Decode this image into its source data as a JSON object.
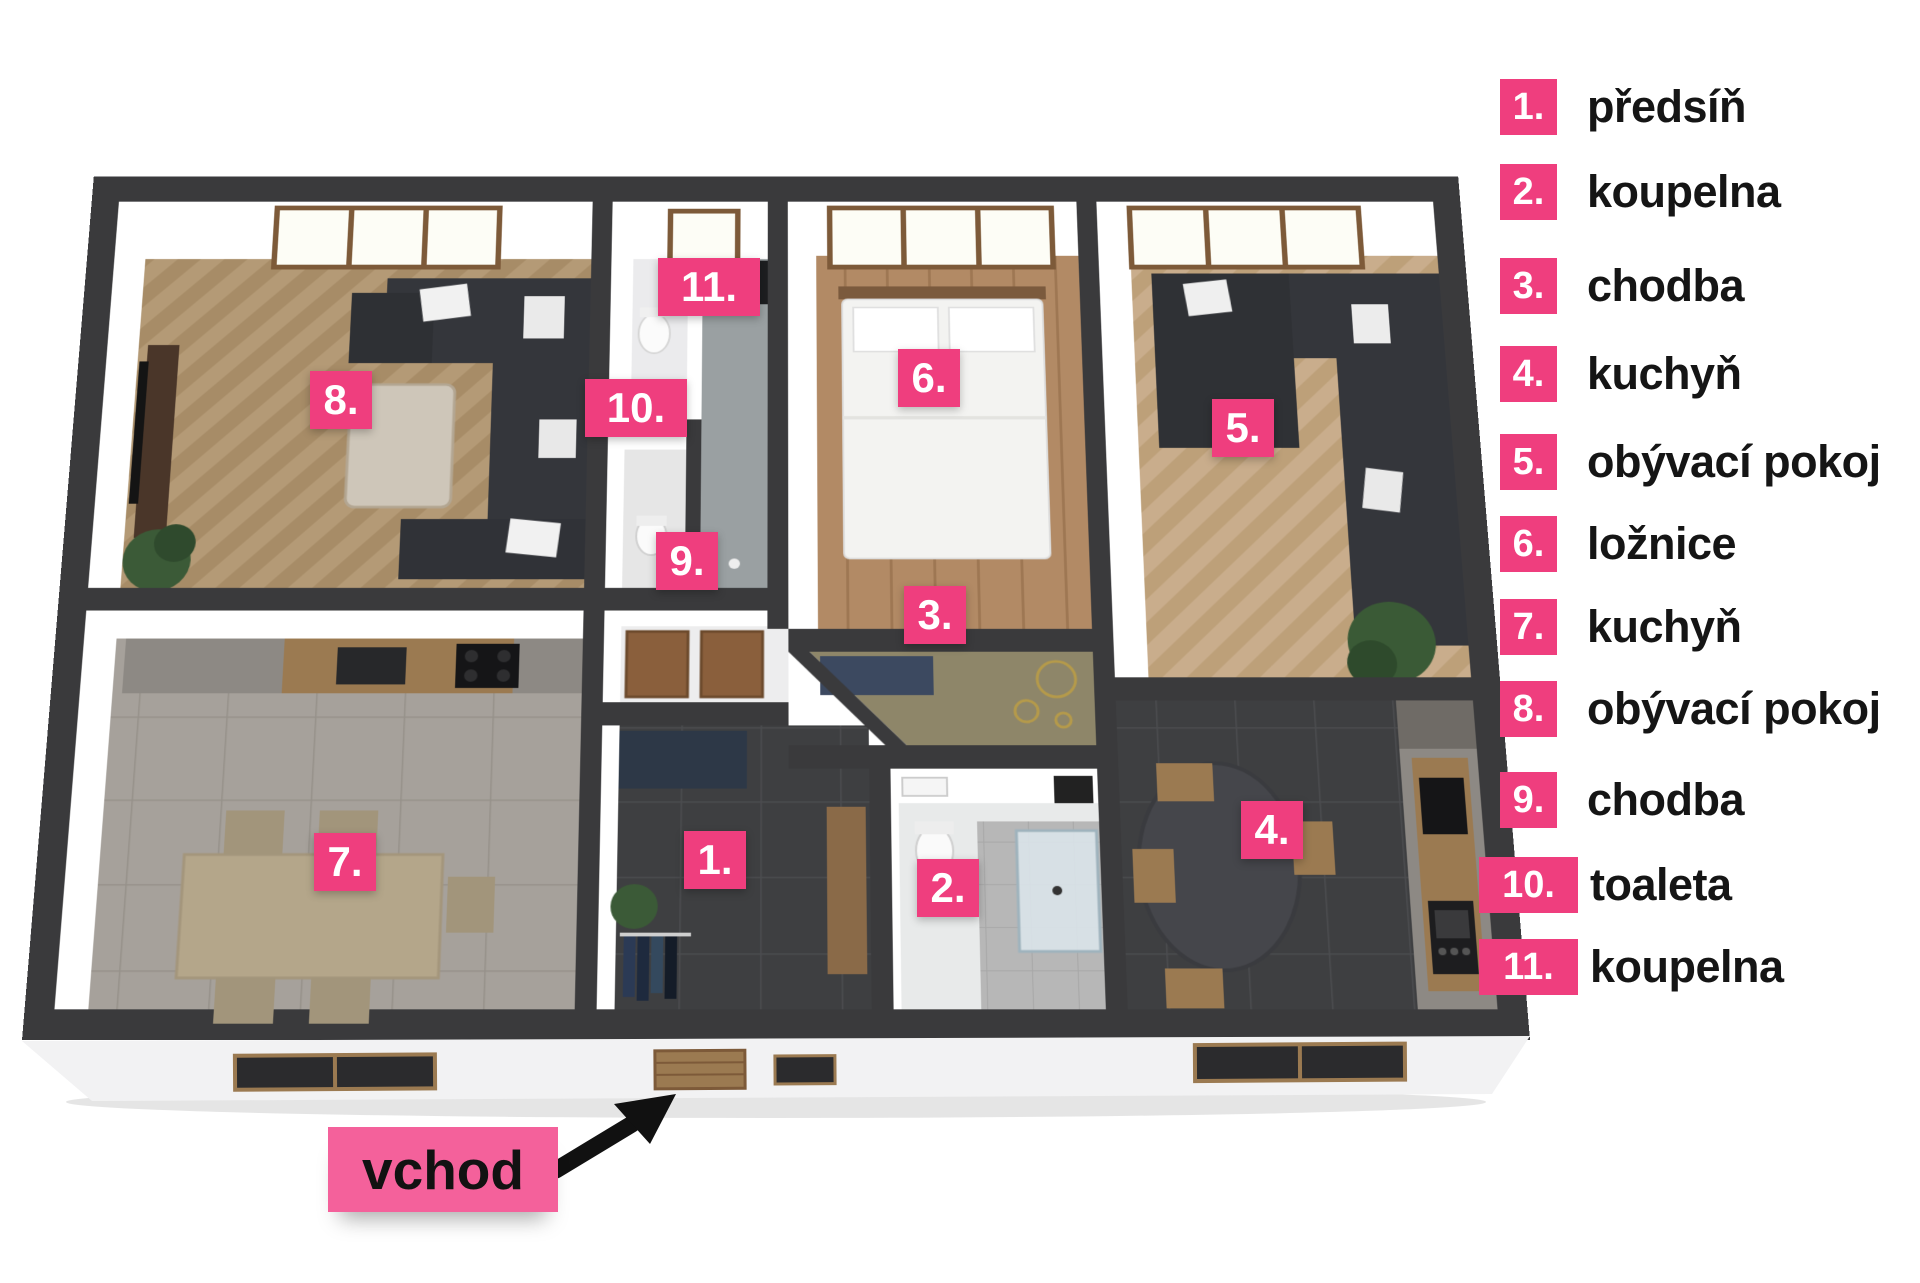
{
  "legend": {
    "items": [
      {
        "num": "1.",
        "label": "předsíň"
      },
      {
        "num": "2.",
        "label": "koupelna"
      },
      {
        "num": "3.",
        "label": "chodba"
      },
      {
        "num": "4.",
        "label": "kuchyň"
      },
      {
        "num": "5.",
        "label": "obývací pokoj"
      },
      {
        "num": "6.",
        "label": "ložnice"
      },
      {
        "num": "7.",
        "label": "kuchyň"
      },
      {
        "num": "8.",
        "label": "obývací pokoj"
      },
      {
        "num": "9.",
        "label": "chodba"
      },
      {
        "num": "10.",
        "label": "toaleta"
      },
      {
        "num": "11.",
        "label": "koupelna"
      }
    ]
  },
  "plan": {
    "badges": [
      {
        "num": "1."
      },
      {
        "num": "2."
      },
      {
        "num": "3."
      },
      {
        "num": "4."
      },
      {
        "num": "5."
      },
      {
        "num": "6."
      },
      {
        "num": "7."
      },
      {
        "num": "8."
      },
      {
        "num": "9."
      },
      {
        "num": "10."
      },
      {
        "num": "11."
      }
    ]
  },
  "entrance": {
    "label": "vchod"
  },
  "colors": {
    "badge_pink": "#EF3E7E",
    "entrance_pink": "#F4619B",
    "wall_dark": "#3A3A3C"
  }
}
